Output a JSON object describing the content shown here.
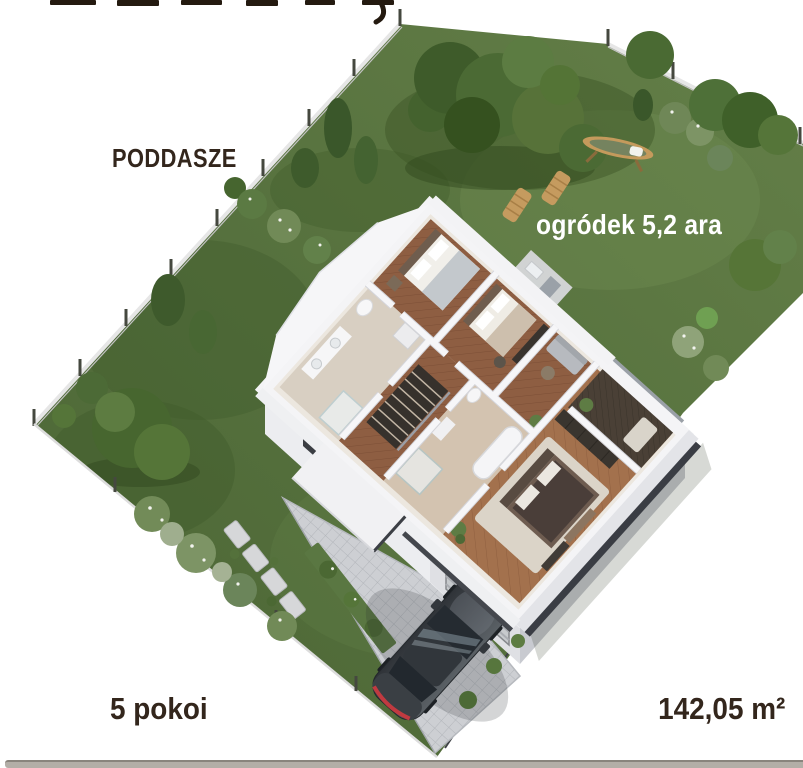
{
  "labels": {
    "floor_label": "PODDASZE",
    "garden_area_label": "ogródek 5,2 ara",
    "room_count_label": "5 pokoi",
    "total_area_label": "142,05 m²"
  },
  "colors": {
    "background": "#ffffff",
    "label_text": "#33261c",
    "garden_label": "#ffffff",
    "bottom_bar": "#b3aea7",
    "grass": "#55703d",
    "grass_shade": "#3c5526",
    "tree_green": "#4b6a34",
    "house_wall": "#f4f4f6",
    "slab_edge": "#3a3d44",
    "wood_floor": "#8e5e42",
    "driveway_pavers": "#cdcfd3",
    "car_body": "#3c4145"
  },
  "scene_objects": [
    "garden-lot",
    "perimeter-fence",
    "trees-and-shrubs",
    "house-attic-floorplan",
    "side-wing-roof",
    "garage-door",
    "driveway",
    "car",
    "sun-loungers",
    "hammock-swing",
    "stepping-stone-path",
    "garden-terrace"
  ]
}
